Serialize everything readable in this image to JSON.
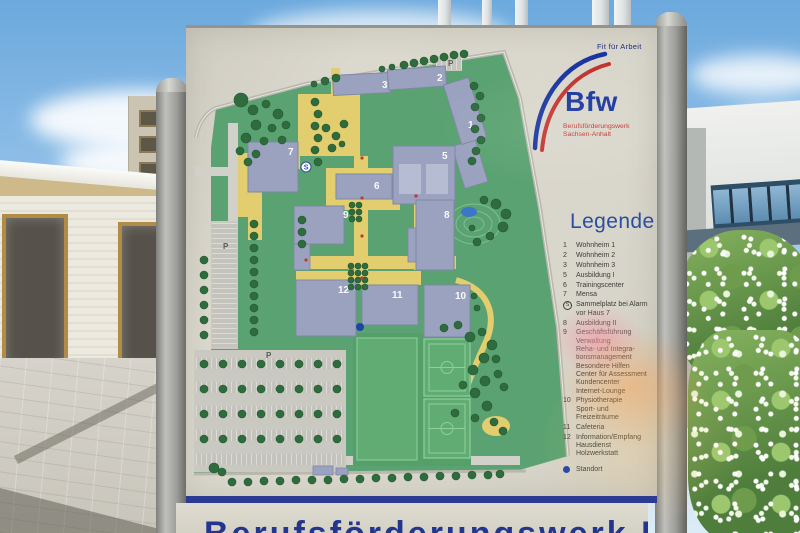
{
  "colors": {
    "brand_blue": "#1a36a0",
    "brand_red": "#c23430",
    "legend_title_blue": "#2b4fa0",
    "standort_blue": "#1d43a8",
    "sign_band_blue": "#2c3b92"
  },
  "logo": {
    "tagline": "Fit für Arbeit",
    "brand": "Bfw",
    "subtitle_line1": "Berufsförderungswerk",
    "subtitle_line2": "Sachsen-Anhalt"
  },
  "legend": {
    "title": "Legende",
    "items": [
      {
        "key": "1",
        "lines": [
          "Wohnheim 1"
        ]
      },
      {
        "key": "2",
        "lines": [
          "Wohnheim 2"
        ]
      },
      {
        "key": "3",
        "lines": [
          "Wohnheim 3"
        ]
      },
      {
        "key": "5",
        "lines": [
          "Ausbildung I"
        ]
      },
      {
        "key": "6",
        "lines": [
          "Trainingscenter"
        ]
      },
      {
        "key": "7",
        "lines": [
          "Mensa"
        ]
      },
      {
        "key": "S",
        "icon": "assembly-point",
        "lines": [
          "Sammelplatz bei Alarm",
          "vor Haus 7"
        ]
      },
      {
        "key": "8",
        "lines": [
          "Ausbildung II"
        ]
      },
      {
        "key": "9",
        "lines": [
          "Geschäftsführung",
          "Verwaltung",
          "Reha- und Integra-",
          "tionsmanagement",
          "Besondere Hilfen",
          "Center für Assessment",
          "Kundencenter",
          "Internet-Lounge"
        ]
      },
      {
        "key": "10",
        "lines": [
          "Physiotherapie",
          "Sport- und",
          "Freizeiträume"
        ]
      },
      {
        "key": "11",
        "lines": [
          "Cafeteria"
        ]
      },
      {
        "key": "12",
        "lines": [
          "Information/Empfang",
          "Hausdienst",
          "Holzwerkstatt"
        ]
      }
    ],
    "marker": {
      "label": "Standort",
      "color": "#1d43a8"
    }
  },
  "bottom_panel": {
    "partial_text": "Berufsförderungswerk Bfw"
  },
  "map": {
    "colors": {
      "green": "#5aa271",
      "yellow": "#e2cd6f",
      "building": "#9aa2bf",
      "buildingStroke": "#7f88a5",
      "court": "#b6bcd1",
      "tree": "#2e6b3d",
      "treeStroke": "#24572f",
      "road": "#d2d1c9",
      "parking": "#c9c8c1",
      "fieldBig": "#55a069",
      "field": "#61ac73",
      "fieldLine": "#8fcf9e",
      "pond": "#3b76c8",
      "contour": "#7fbf8d",
      "boundary": "#b9b7ae",
      "label": "#ffffff",
      "plabel": "#5a5a55",
      "standort": "#1d43a8",
      "reddot": "#c03a32"
    },
    "green_polygon": "M30,80 L120,56 L215,40 L318,24 L334,70 L354,180 L372,300 L382,428 L330,443 L8,446 L8,322 L25,322 L25,120 Z",
    "boundary_path": "M10,110 C12,96 20,84 30,80 L120,56 L215,40 L318,24 L334,70 L354,180 L372,300 L382,428",
    "boundary_bottom": "M8,446 L340,443",
    "gray_roads": [
      [
        42,
        95,
        10,
        112
      ],
      [
        9,
        139,
        34,
        9
      ],
      [
        12,
        428,
        322,
        9
      ]
    ],
    "yellow_rects": [
      [
        112,
        66,
        62,
        62
      ],
      [
        52,
        128,
        62,
        13
      ],
      [
        52,
        125,
        14,
        64
      ],
      [
        62,
        164,
        14,
        48
      ],
      [
        140,
        140,
        74,
        42
      ],
      [
        168,
        128,
        14,
        122
      ],
      [
        110,
        228,
        160,
        13
      ],
      [
        110,
        243,
        125,
        14
      ],
      [
        228,
        118,
        12,
        124
      ],
      [
        145,
        40,
        9,
        28
      ]
    ],
    "yellow_ellipses": [
      [
        310,
        398,
        14,
        10
      ]
    ],
    "yellow_path": "M270,252 C305,262 312,290 298,318 C283,350 268,392 260,432",
    "parking_areas": [
      [
        8,
        322,
        152,
        122
      ],
      [
        25,
        193,
        27,
        128
      ],
      [
        250,
        28,
        26,
        15
      ]
    ],
    "parking_hatch_v": [
      [
        10,
        330,
        148,
        11
      ],
      [
        10,
        354,
        148,
        11
      ],
      [
        10,
        378,
        148,
        11
      ],
      [
        10,
        402,
        148,
        11
      ],
      [
        10,
        426,
        148,
        11
      ],
      [
        250,
        29,
        26,
        13
      ]
    ],
    "parking_hatch_h": [
      [
        26,
        195,
        25,
        124
      ]
    ],
    "sports": {
      "big": [
        167,
        305,
        118,
        133
      ],
      "pitch_left": [
        171,
        310,
        60,
        122
      ],
      "fields": [
        [
          238,
          311,
          46,
          57
        ],
        [
          238,
          371,
          46,
          59
        ]
      ]
    },
    "contours": [
      [
        288,
        196,
        26,
        20
      ],
      [
        288,
        196,
        18,
        13
      ],
      [
        288,
        196,
        10,
        7
      ]
    ],
    "pond": {
      "cx": 283,
      "cy": 184,
      "rx": 8,
      "ry": 5
    },
    "buildings": [
      {
        "n": "3",
        "x": 147,
        "y": 46,
        "w": 57,
        "h": 20,
        "r": -3,
        "lx": 196,
        "ly": 60
      },
      {
        "n": "2",
        "x": 202,
        "y": 40,
        "w": 58,
        "h": 20,
        "r": -4,
        "lx": 251,
        "ly": 53
      },
      {
        "n": "1",
        "x": 266,
        "y": 52,
        "w": 26,
        "h": 62,
        "r": -17,
        "lx": 282,
        "ly": 100
      },
      {
        "n": "7",
        "x": 62,
        "y": 114,
        "w": 50,
        "h": 50,
        "r": 0,
        "lx": 102,
        "ly": 127
      },
      {
        "n": "5",
        "x": 207,
        "y": 118,
        "w": 62,
        "h": 58,
        "r": 0,
        "lx": 256,
        "ly": 131
      },
      {
        "n": "6",
        "x": 150,
        "y": 146,
        "w": 56,
        "h": 25,
        "r": 0,
        "lx": 188,
        "ly": 161
      },
      {
        "n": "9",
        "x": 108,
        "y": 178,
        "w": 50,
        "h": 38,
        "r": 0,
        "lx": 157,
        "ly": 190
      },
      {
        "n": "8",
        "x": 230,
        "y": 172,
        "w": 38,
        "h": 70,
        "r": 0,
        "lx": 258,
        "ly": 190
      },
      {
        "n": "12",
        "x": 110,
        "y": 252,
        "w": 60,
        "h": 56,
        "r": 0,
        "lx": 152,
        "ly": 265
      },
      {
        "n": "11",
        "x": 176,
        "y": 257,
        "w": 56,
        "h": 40,
        "r": 0,
        "lx": 206,
        "ly": 270
      },
      {
        "n": "10",
        "x": 238,
        "y": 257,
        "w": 46,
        "h": 52,
        "r": 0,
        "lx": 269,
        "ly": 271
      }
    ],
    "annexes": [
      [
        272,
        114,
        24,
        44,
        -17
      ],
      [
        108,
        216,
        16,
        26,
        0
      ],
      [
        222,
        200,
        8,
        34,
        0
      ],
      [
        127,
        438,
        20,
        9,
        0
      ],
      [
        150,
        440,
        12,
        7,
        0
      ]
    ],
    "courts": [
      [
        213,
        136,
        22,
        30
      ],
      [
        240,
        136,
        22,
        30
      ]
    ],
    "p_labels": [
      {
        "t": "P",
        "x": 37,
        "y": 221
      },
      {
        "t": "P",
        "x": 80,
        "y": 330
      },
      {
        "t": "P",
        "x": 262,
        "y": 38
      }
    ],
    "s_symbol": {
      "t": "S",
      "x": 120,
      "y": 139
    },
    "standort": {
      "x": 174,
      "y": 299
    },
    "red_dots": [
      [
        176,
        130
      ],
      [
        176,
        170
      ],
      [
        176,
        208
      ],
      [
        176,
        250
      ],
      [
        120,
        232
      ],
      [
        230,
        168
      ]
    ],
    "trees": [
      [
        218,
        37,
        4
      ],
      [
        228,
        35,
        4
      ],
      [
        238,
        33,
        4
      ],
      [
        248,
        31,
        4
      ],
      [
        258,
        29,
        4
      ],
      [
        268,
        27,
        4
      ],
      [
        278,
        26,
        4
      ],
      [
        206,
        39,
        3
      ],
      [
        196,
        41,
        3
      ],
      [
        139,
        53,
        4
      ],
      [
        150,
        50,
        4
      ],
      [
        128,
        56,
        3
      ],
      [
        288,
        58,
        4
      ],
      [
        294,
        68,
        4
      ],
      [
        289,
        79,
        4
      ],
      [
        295,
        90,
        4
      ],
      [
        289,
        101,
        4
      ],
      [
        295,
        112,
        4
      ],
      [
        290,
        123,
        4
      ],
      [
        286,
        133,
        4
      ],
      [
        55,
        72,
        7
      ],
      [
        67,
        82,
        5
      ],
      [
        80,
        76,
        4
      ],
      [
        92,
        86,
        5
      ],
      [
        70,
        97,
        5
      ],
      [
        86,
        100,
        4
      ],
      [
        100,
        97,
        4
      ],
      [
        60,
        110,
        5
      ],
      [
        78,
        113,
        4
      ],
      [
        96,
        112,
        4
      ],
      [
        54,
        123,
        4
      ],
      [
        70,
        126,
        4
      ],
      [
        62,
        134,
        4
      ],
      [
        129,
        74,
        4
      ],
      [
        132,
        86,
        4
      ],
      [
        129,
        98,
        4
      ],
      [
        132,
        110,
        4
      ],
      [
        129,
        122,
        4
      ],
      [
        132,
        134,
        4
      ],
      [
        140,
        100,
        4
      ],
      [
        150,
        108,
        4
      ],
      [
        158,
        96,
        4
      ],
      [
        146,
        120,
        4
      ],
      [
        156,
        116,
        3
      ],
      [
        166,
        177,
        3
      ],
      [
        173,
        177,
        3
      ],
      [
        166,
        184,
        3
      ],
      [
        173,
        184,
        3
      ],
      [
        166,
        191,
        3
      ],
      [
        173,
        191,
        3
      ],
      [
        165,
        238,
        3
      ],
      [
        172,
        238,
        3
      ],
      [
        179,
        238,
        3
      ],
      [
        165,
        245,
        3
      ],
      [
        172,
        245,
        3
      ],
      [
        179,
        245,
        3
      ],
      [
        165,
        252,
        3
      ],
      [
        172,
        252,
        3
      ],
      [
        179,
        252,
        3
      ],
      [
        165,
        259,
        3
      ],
      [
        172,
        259,
        3
      ],
      [
        179,
        259,
        3
      ],
      [
        68,
        196,
        4
      ],
      [
        68,
        208,
        4
      ],
      [
        68,
        220,
        4
      ],
      [
        68,
        232,
        4
      ],
      [
        68,
        244,
        4
      ],
      [
        68,
        256,
        4
      ],
      [
        68,
        268,
        4
      ],
      [
        68,
        280,
        4
      ],
      [
        68,
        292,
        4
      ],
      [
        68,
        304,
        4
      ],
      [
        18,
        232,
        4
      ],
      [
        18,
        247,
        4
      ],
      [
        18,
        262,
        4
      ],
      [
        18,
        277,
        4
      ],
      [
        18,
        292,
        4
      ],
      [
        18,
        307,
        4
      ],
      [
        298,
        172,
        4
      ],
      [
        310,
        176,
        5
      ],
      [
        320,
        186,
        5
      ],
      [
        317,
        199,
        5
      ],
      [
        304,
        208,
        4
      ],
      [
        291,
        214,
        4
      ],
      [
        286,
        200,
        3
      ],
      [
        116,
        192,
        4
      ],
      [
        116,
        204,
        4
      ],
      [
        116,
        216,
        4
      ],
      [
        288,
        268,
        3
      ],
      [
        291,
        280,
        3
      ],
      [
        258,
        300,
        4
      ],
      [
        272,
        297,
        4
      ],
      [
        284,
        309,
        5
      ],
      [
        296,
        304,
        4
      ],
      [
        306,
        317,
        5
      ],
      [
        298,
        330,
        5
      ],
      [
        287,
        342,
        5
      ],
      [
        299,
        353,
        5
      ],
      [
        312,
        346,
        4
      ],
      [
        289,
        365,
        5
      ],
      [
        277,
        357,
        4
      ],
      [
        301,
        378,
        5
      ],
      [
        289,
        390,
        4
      ],
      [
        269,
        385,
        4
      ],
      [
        310,
        331,
        4
      ],
      [
        318,
        359,
        4
      ],
      [
        308,
        394,
        4
      ],
      [
        317,
        403,
        4
      ],
      [
        28,
        440,
        5
      ],
      [
        36,
        444,
        4
      ],
      [
        46,
        454,
        4
      ],
      [
        62,
        454,
        4
      ],
      [
        78,
        453,
        4
      ],
      [
        94,
        453,
        4
      ],
      [
        110,
        452,
        4
      ],
      [
        126,
        452,
        4
      ],
      [
        142,
        452,
        4
      ],
      [
        158,
        451,
        4
      ],
      [
        174,
        451,
        4
      ],
      [
        190,
        450,
        4
      ],
      [
        206,
        450,
        4
      ],
      [
        222,
        449,
        4
      ],
      [
        238,
        449,
        4
      ],
      [
        254,
        448,
        4
      ],
      [
        270,
        448,
        4
      ],
      [
        286,
        447,
        4
      ],
      [
        302,
        447,
        4
      ],
      [
        314,
        446,
        4
      ],
      [
        18,
        336,
        4
      ],
      [
        37,
        336,
        4
      ],
      [
        56,
        336,
        4
      ],
      [
        75,
        336,
        4
      ],
      [
        94,
        336,
        4
      ],
      [
        113,
        336,
        4
      ],
      [
        132,
        336,
        4
      ],
      [
        151,
        336,
        4
      ],
      [
        18,
        361,
        4
      ],
      [
        37,
        361,
        4
      ],
      [
        56,
        361,
        4
      ],
      [
        75,
        361,
        4
      ],
      [
        94,
        361,
        4
      ],
      [
        113,
        361,
        4
      ],
      [
        132,
        361,
        4
      ],
      [
        151,
        361,
        4
      ],
      [
        18,
        386,
        4
      ],
      [
        37,
        386,
        4
      ],
      [
        56,
        386,
        4
      ],
      [
        75,
        386,
        4
      ],
      [
        94,
        386,
        4
      ],
      [
        113,
        386,
        4
      ],
      [
        132,
        386,
        4
      ],
      [
        151,
        386,
        4
      ],
      [
        18,
        411,
        4
      ],
      [
        37,
        411,
        4
      ],
      [
        56,
        411,
        4
      ],
      [
        75,
        411,
        4
      ],
      [
        94,
        411,
        4
      ],
      [
        113,
        411,
        4
      ],
      [
        132,
        411,
        4
      ],
      [
        151,
        411,
        4
      ]
    ]
  }
}
